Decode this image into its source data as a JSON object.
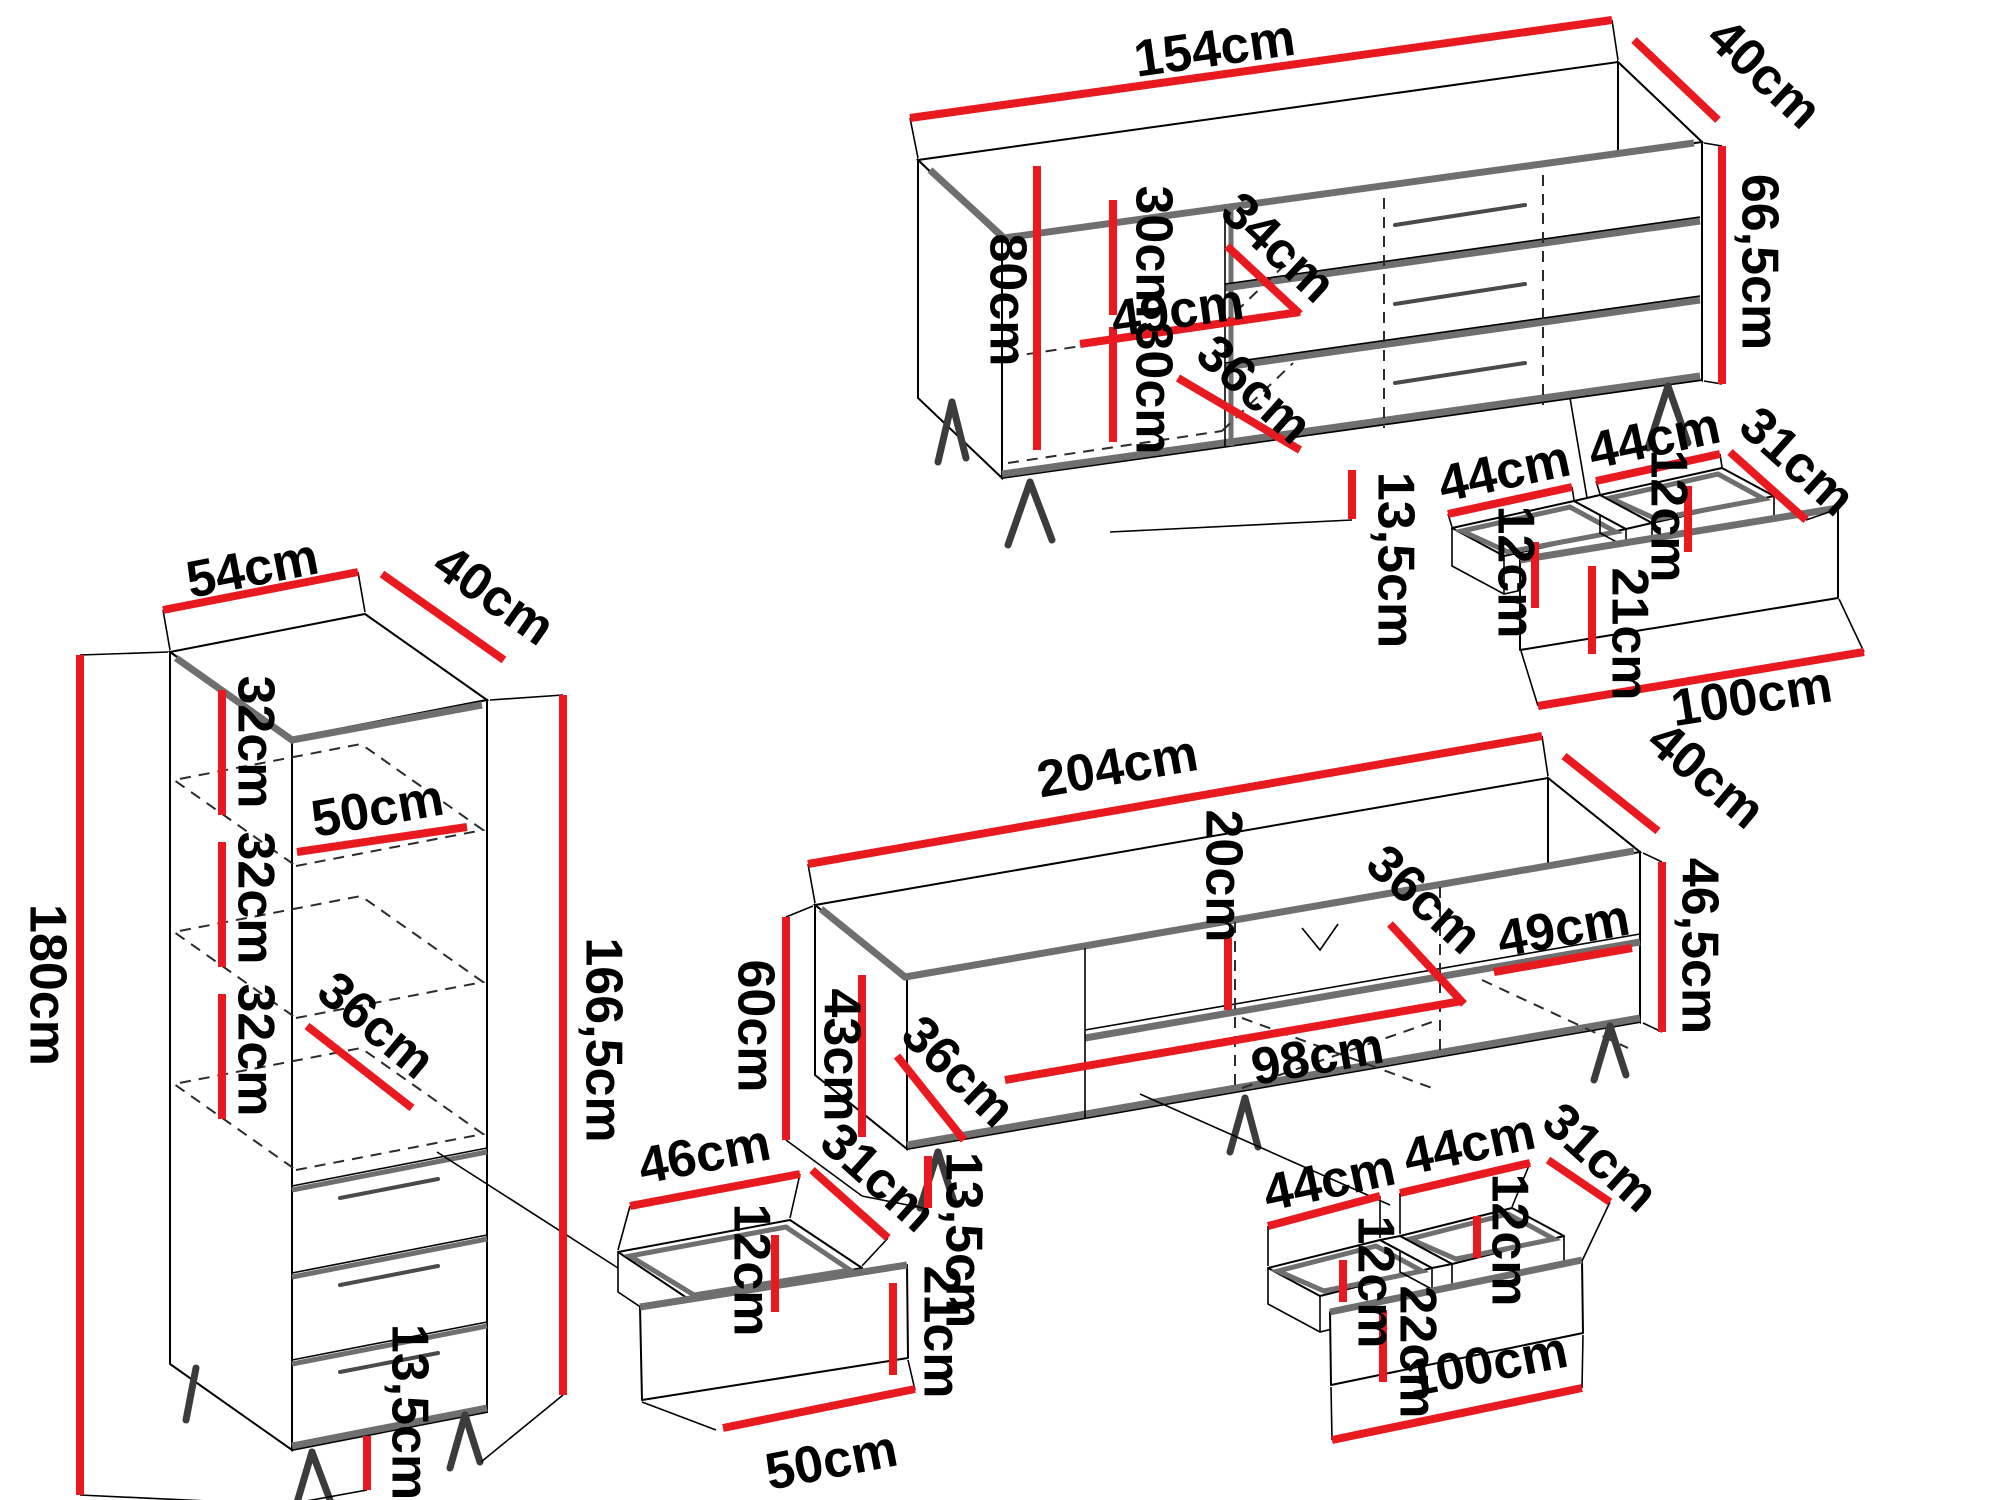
{
  "unit": "cm",
  "colors": {
    "dimension_red": "#e8191f",
    "outline_black": "#000000",
    "panel_gray": "#6f6f6f"
  },
  "sideboard": {
    "width": "154cm",
    "depth": "40cm",
    "height_total": "80cm",
    "height_body": "66,5cm",
    "shelf_gap_upper": "30cm",
    "shelf_gap_lower": "30cm",
    "shelf_depth": "34cm",
    "compartment_width": "49cm",
    "compartment_diagonal": "36cm",
    "leg_height": "13,5cm",
    "drawers": {
      "left_width": "44cm",
      "right_width": "44cm",
      "depth": "31cm",
      "left_inner_height": "12cm",
      "right_inner_height": "12cm",
      "front_height": "21cm",
      "front_width": "100cm"
    }
  },
  "tall_cabinet": {
    "width": "54cm",
    "depth": "40cm",
    "height_total": "180cm",
    "height_body": "166,5cm",
    "shelf_gaps": [
      "32cm",
      "32cm",
      "32cm"
    ],
    "inner_width": "50cm",
    "inner_diagonal": "36cm",
    "leg_height": "13,5cm",
    "drawer": {
      "width": "46cm",
      "depth": "31cm",
      "inner_height": "12cm",
      "front_height": "21cm",
      "front_width": "50cm"
    }
  },
  "tv_stand": {
    "width": "204cm",
    "depth": "40cm",
    "height_total": "60cm",
    "height_body": "46,5cm",
    "inner_height": "43cm",
    "door_diagonal": "36cm",
    "shelf_gap": "20cm",
    "shelf_width": "98cm",
    "right_compartment_width": "49cm",
    "shelf_diagonal": "36cm",
    "leg_height": "13,5cm",
    "drawers": {
      "left_width": "44cm",
      "right_width": "44cm",
      "depth": "31cm",
      "left_inner_height": "12cm",
      "right_inner_height": "12cm",
      "front_height": "22cm",
      "front_width": "100cm"
    }
  }
}
